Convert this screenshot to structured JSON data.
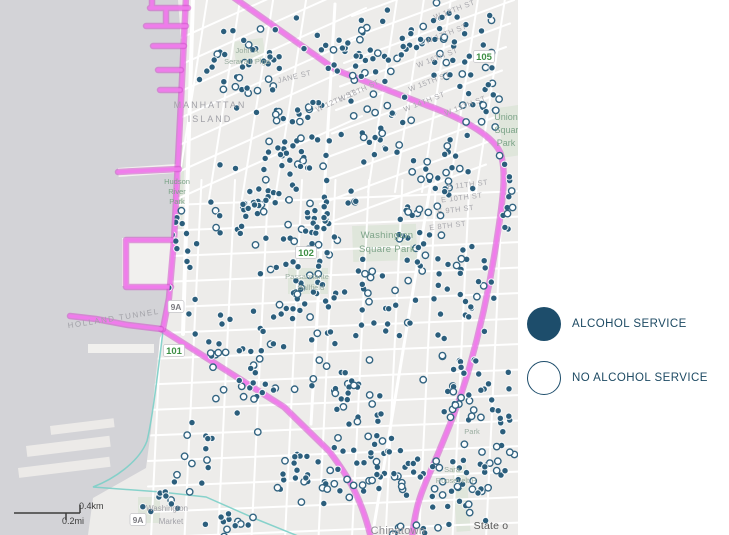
{
  "legend": {
    "items": [
      {
        "label": "ALCOHOL SERVICE",
        "type": "filled"
      },
      {
        "label": "NO ALCOHOL SERVICE",
        "type": "outlined"
      }
    ]
  },
  "colors": {
    "water": "#d3d3d7",
    "land": "#edecea",
    "street": "#ffffff",
    "park": "#dfe6db",
    "pier": "#f1f0ee",
    "pier2": "#eceae8",
    "magenta_outer": "#cf4ecb",
    "magenta_inner": "#f07bec",
    "teal": "#7bcfc8",
    "dot_fill": "#2b5e7c",
    "dot_rim": "rgba(255,255,255,0.9)",
    "dot_open_fill": "#fbfdfe",
    "dot_open_stroke": "#336481",
    "gray1": "#a2a2a8",
    "gray2": "#8e8e93",
    "gray3": "#a9a9ae",
    "green1": "#7da489",
    "green2": "#9aada0",
    "shield_green": "#3e8f45",
    "shield_gray": "#7c7c82",
    "attribution": "#565656",
    "scale": "#3c3c3c",
    "legend_fill": "#1d4d6b",
    "legend_ring": "#1d4d6b"
  },
  "map": {
    "width": 518,
    "height": 535,
    "land_path": "M178,0 L518,0 L518,535 L88,535 L93,498 L146,468 L151,430 L154,392 L160,338 L164,330 L169,296 L173,246 L177,178 L181,92 L181,40 Z",
    "piers": [
      {
        "x": 122,
        "y": 238,
        "w": 50,
        "h": 48,
        "rot": 0,
        "c": "pier"
      },
      {
        "x": 88,
        "y": 344,
        "w": 66,
        "h": 9,
        "rot": 0,
        "c": "pier"
      },
      {
        "x": 118,
        "y": 168,
        "w": 60,
        "h": 9,
        "rot": -4,
        "c": "pier"
      },
      {
        "x": 26,
        "y": 446,
        "w": 84,
        "h": 11,
        "rot": -7,
        "c": "pier2"
      },
      {
        "x": 50,
        "y": 426,
        "w": 64,
        "h": 9,
        "rot": -7,
        "c": "pier2"
      },
      {
        "x": 18,
        "y": 468,
        "w": 92,
        "h": 10,
        "rot": -7,
        "c": "pier2"
      }
    ],
    "parks": [
      {
        "x": 352,
        "y": 226,
        "w": 64,
        "h": 36,
        "rot": -2
      },
      {
        "x": 497,
        "y": 108,
        "w": 23,
        "h": 50,
        "rot": -8
      },
      {
        "x": 176,
        "y": 145,
        "w": 9,
        "h": 85,
        "rot": 2
      },
      {
        "x": 138,
        "y": 497,
        "w": 22,
        "h": 26,
        "rot": 0
      },
      {
        "x": 452,
        "y": 466,
        "w": 14,
        "h": 66,
        "rot": -4
      },
      {
        "x": 233,
        "y": 42,
        "w": 30,
        "h": 22,
        "rot": -8
      },
      {
        "x": 288,
        "y": 268,
        "w": 40,
        "h": 26,
        "rot": 0
      }
    ],
    "street_regions": [
      {
        "count": 10,
        "start": [
          352,
          16
        ],
        "step": [
          -4,
          23.5
        ],
        "vec": [
          170,
          -63
        ],
        "width": 2
      },
      {
        "count": 5,
        "start": [
          398,
          -8
        ],
        "step": [
          27,
          0
        ],
        "vec": [
          -30,
          200
        ],
        "width": 2
      },
      {
        "count": 7,
        "start": [
          163,
          46
        ],
        "step": [
          -1,
          27
        ],
        "vec": [
          205,
          -92
        ],
        "width": 2
      },
      {
        "count": 4,
        "start": [
          208,
          -6
        ],
        "step": [
          33,
          0
        ],
        "vec": [
          -32,
          205
        ],
        "width": 2
      },
      {
        "count": 11,
        "start": [
          168,
          180
        ],
        "step": [
          33.5,
          0
        ],
        "vec": [
          -17,
          358
        ],
        "width": 2
      },
      {
        "count": 14,
        "start": [
          148,
          206
        ],
        "step": [
          0,
          25.5
        ],
        "vec": [
          374,
          -15
        ],
        "width": 2
      },
      {
        "count": 1,
        "start": [
          432,
          176
        ],
        "step": [
          0,
          0
        ],
        "vec": [
          -60,
          362
        ],
        "width": 3
      },
      {
        "count": 1,
        "start": [
          193,
          -4
        ],
        "step": [
          0,
          0
        ],
        "vec": [
          -10,
          338
        ],
        "width": 4
      },
      {
        "count": 1,
        "start": [
          335,
          4
        ],
        "step": [
          0,
          0
        ],
        "vec": [
          -24,
          420
        ],
        "width": 3
      }
    ],
    "teal_path": "M163,331 C156,388 152,420 147,441 C139,462 114,479 93,487 L161,492 L206,497 L256,519 L298,536",
    "boundary_paths": [
      "M233,-3 L336,70 L426,105 C460,117 492,135 500,152 C507,170 503,200 497,238 C490,286 480,330 469,369 C458,407 447,432 432,468 C421,492 415,508 412,538",
      "M161,329 L224,369 L284,407 L329,451 C349,477 362,500 371,538",
      "M186,-3 L182,80 L178,160 L174,240 L169,298 L163,329",
      "M150,8 L188,8 M152,-2 L152,8 M146,26 L186,26 M166,8 L166,26 M153,46 L184,46 M158,70 L181,70 M160,90 L180,90 M118,172 L179,169 M172,240 L126,240 L126,287 L171,287 M161,329 L128,325 L96,319 L70,316"
    ],
    "dot_style": {
      "r": 3.2
    },
    "dot_clusters": [
      {
        "c": [
          250,
          60
        ],
        "r": [
          60,
          55
        ],
        "n": 40,
        "f": 0.8
      },
      {
        "c": [
          350,
          45
        ],
        "r": [
          50,
          45
        ],
        "n": 35,
        "f": 0.75
      },
      {
        "c": [
          445,
          40
        ],
        "r": [
          60,
          45
        ],
        "n": 45,
        "f": 0.7
      },
      {
        "c": [
          480,
          100
        ],
        "r": [
          35,
          50
        ],
        "n": 25,
        "f": 0.7
      },
      {
        "c": [
          300,
          140
        ],
        "r": [
          55,
          55
        ],
        "n": 45,
        "f": 0.8
      },
      {
        "c": [
          380,
          130
        ],
        "r": [
          40,
          40
        ],
        "n": 25,
        "f": 0.75
      },
      {
        "c": [
          250,
          200
        ],
        "r": [
          45,
          60
        ],
        "n": 40,
        "f": 0.8
      },
      {
        "c": [
          320,
          220
        ],
        "r": [
          45,
          50
        ],
        "n": 40,
        "f": 0.7
      },
      {
        "c": [
          440,
          180
        ],
        "r": [
          45,
          55
        ],
        "n": 30,
        "f": 0.6
      },
      {
        "c": [
          300,
          300
        ],
        "r": [
          55,
          50
        ],
        "n": 45,
        "f": 0.75
      },
      {
        "c": [
          380,
          300
        ],
        "r": [
          40,
          50
        ],
        "n": 25,
        "f": 0.7
      },
      {
        "c": [
          460,
          290
        ],
        "r": [
          40,
          60
        ],
        "n": 30,
        "f": 0.65
      },
      {
        "c": [
          250,
          380
        ],
        "r": [
          50,
          55
        ],
        "n": 30,
        "f": 0.7
      },
      {
        "c": [
          350,
          390
        ],
        "r": [
          45,
          50
        ],
        "n": 30,
        "f": 0.6
      },
      {
        "c": [
          460,
          400
        ],
        "r": [
          45,
          55
        ],
        "n": 35,
        "f": 0.65
      },
      {
        "c": [
          380,
          470
        ],
        "r": [
          55,
          45
        ],
        "n": 45,
        "f": 0.6
      },
      {
        "c": [
          460,
          480
        ],
        "r": [
          50,
          45
        ],
        "n": 40,
        "f": 0.7
      },
      {
        "c": [
          300,
          480
        ],
        "r": [
          45,
          40
        ],
        "n": 25,
        "f": 0.65
      },
      {
        "c": [
          200,
          450
        ],
        "r": [
          30,
          60
        ],
        "n": 15,
        "f": 0.7
      },
      {
        "c": [
          185,
          250
        ],
        "r": [
          20,
          70
        ],
        "n": 15,
        "f": 0.8
      },
      {
        "c": [
          210,
          330
        ],
        "r": [
          25,
          40
        ],
        "n": 12,
        "f": 0.7
      },
      {
        "c": [
          420,
          240
        ],
        "r": [
          30,
          40
        ],
        "n": 18,
        "f": 0.6
      },
      {
        "c": [
          505,
          200
        ],
        "r": [
          14,
          80
        ],
        "n": 12,
        "f": 0.6
      },
      {
        "c": [
          505,
          420
        ],
        "r": [
          14,
          70
        ],
        "n": 12,
        "f": 0.65
      },
      {
        "c": [
          230,
          520
        ],
        "r": [
          40,
          18
        ],
        "n": 12,
        "f": 0.6
      },
      {
        "c": [
          160,
          500
        ],
        "r": [
          25,
          25
        ],
        "n": 8,
        "f": 0.75
      },
      {
        "c": [
          420,
          528
        ],
        "r": [
          40,
          10
        ],
        "n": 10,
        "f": 0.6
      }
    ],
    "labels": [
      {
        "t": "MANHATTAN",
        "x": 210,
        "y": 108,
        "rot": 0,
        "s": 9,
        "c": "gray1",
        "ls": 2
      },
      {
        "t": "ISLAND",
        "x": 210,
        "y": 122,
        "rot": 0,
        "s": 9,
        "c": "gray1",
        "ls": 2
      },
      {
        "t": "HOLLAND TUNNEL",
        "x": 114,
        "y": 321,
        "rot": -9,
        "s": 8,
        "c": "gray1",
        "ls": 1.5
      },
      {
        "t": "Hudson",
        "x": 177,
        "y": 184,
        "rot": 0,
        "s": 7.5,
        "c": "green1",
        "ls": 0
      },
      {
        "t": "River",
        "x": 177,
        "y": 194,
        "rot": 0,
        "s": 7.5,
        "c": "green1",
        "ls": 0
      },
      {
        "t": "Park",
        "x": 177,
        "y": 204,
        "rot": 0,
        "s": 7.5,
        "c": "green1",
        "ls": 0
      },
      {
        "t": "Washington",
        "x": 387,
        "y": 238,
        "rot": 0,
        "s": 9.5,
        "c": "green1",
        "ls": 0.3
      },
      {
        "t": "Square Park",
        "x": 387,
        "y": 252,
        "rot": 0,
        "s": 9.5,
        "c": "green1",
        "ls": 0.3
      },
      {
        "t": "Union",
        "x": 506,
        "y": 120,
        "rot": 0,
        "s": 9,
        "c": "green1",
        "ls": 0
      },
      {
        "t": "Square",
        "x": 509,
        "y": 133,
        "rot": 0,
        "s": 9,
        "c": "green1",
        "ls": 0
      },
      {
        "t": "Park",
        "x": 506,
        "y": 146,
        "rot": 0,
        "s": 9,
        "c": "green1",
        "ls": 0
      },
      {
        "t": "Chinatown",
        "x": 398,
        "y": 534,
        "rot": 0,
        "s": 11,
        "c": "gray2",
        "ls": 0.3
      },
      {
        "t": "Washington",
        "x": 167,
        "y": 511,
        "rot": 0,
        "s": 8,
        "c": "gray1",
        "ls": 0
      },
      {
        "t": "Market",
        "x": 171,
        "y": 524,
        "rot": 0,
        "s": 8,
        "c": "gray1",
        "ls": 0
      },
      {
        "t": "John A",
        "x": 247,
        "y": 53,
        "rot": 0,
        "s": 7.5,
        "c": "green2",
        "ls": 0
      },
      {
        "t": "Seravalli Plgd",
        "x": 247,
        "y": 64,
        "rot": 0,
        "s": 7.5,
        "c": "green2",
        "ls": 0
      },
      {
        "t": "Passannante",
        "x": 307,
        "y": 279,
        "rot": 0,
        "s": 7.5,
        "c": "green2",
        "ls": 0
      },
      {
        "t": "Ballfield",
        "x": 311,
        "y": 290,
        "rot": 0,
        "s": 7.5,
        "c": "green2",
        "ls": 0
      },
      {
        "t": "Sara",
        "x": 452,
        "y": 472,
        "rot": 0,
        "s": 7.5,
        "c": "green2",
        "ls": 0
      },
      {
        "t": "Roosevelt P",
        "x": 456,
        "y": 483,
        "rot": 0,
        "s": 7.5,
        "c": "green2",
        "ls": 0
      },
      {
        "t": "Park",
        "x": 472,
        "y": 434,
        "rot": 0,
        "s": 7.5,
        "c": "green2",
        "ls": 0
      },
      {
        "t": "JANE ST",
        "x": 295,
        "y": 79,
        "rot": -14,
        "s": 7.5,
        "c": "gray3",
        "ls": 0.5
      },
      {
        "t": "W 13TH ST",
        "x": 360,
        "y": 93,
        "rot": -25,
        "s": 7.5,
        "c": "gray3",
        "ls": 0.5
      },
      {
        "t": "W 12TH ST",
        "x": 337,
        "y": 103,
        "rot": -25,
        "s": 7.5,
        "c": "gray3",
        "ls": 0.5
      },
      {
        "t": "W 18TH ST",
        "x": 455,
        "y": 12,
        "rot": -21,
        "s": 7.5,
        "c": "gray3",
        "ls": 0.5
      },
      {
        "t": "W 17TH ST",
        "x": 447,
        "y": 36,
        "rot": -21,
        "s": 7.5,
        "c": "gray3",
        "ls": 0.5
      },
      {
        "t": "W 16TH ST",
        "x": 438,
        "y": 60,
        "rot": -21,
        "s": 7.5,
        "c": "gray3",
        "ls": 0.5
      },
      {
        "t": "W 15TH ST",
        "x": 430,
        "y": 84,
        "rot": -21,
        "s": 7.5,
        "c": "gray3",
        "ls": 0.5
      },
      {
        "t": "W 14TH ST",
        "x": 425,
        "y": 104,
        "rot": -21,
        "s": 7.5,
        "c": "gray3",
        "ls": 0.5
      },
      {
        "t": "W 13TH ST",
        "x": 466,
        "y": 108,
        "rot": -21,
        "s": 7.5,
        "c": "gray3",
        "ls": 0.5
      },
      {
        "t": "E 11TH ST",
        "x": 468,
        "y": 187,
        "rot": -7,
        "s": 7.5,
        "c": "gray3",
        "ls": 0.5
      },
      {
        "t": "E 10TH ST",
        "x": 462,
        "y": 200,
        "rot": -7,
        "s": 7.5,
        "c": "gray3",
        "ls": 0.5
      },
      {
        "t": "E 9TH ST",
        "x": 456,
        "y": 212,
        "rot": -7,
        "s": 7.5,
        "c": "gray3",
        "ls": 0.5
      },
      {
        "t": "E 8TH ST",
        "x": 448,
        "y": 228,
        "rot": -7,
        "s": 7.5,
        "c": "gray3",
        "ls": 0.5
      },
      {
        "t": "State o",
        "x": 491,
        "y": 529,
        "rot": 0,
        "s": 10.5,
        "c": "attribution",
        "ls": 0.2
      }
    ],
    "shields": [
      {
        "t": "105",
        "x": 484,
        "y": 57,
        "style": "green"
      },
      {
        "t": "102",
        "x": 306,
        "y": 253,
        "style": "green"
      },
      {
        "t": "101",
        "x": 174,
        "y": 351,
        "style": "green"
      },
      {
        "t": "9A",
        "x": 176,
        "y": 307,
        "style": "white"
      },
      {
        "t": "9A",
        "x": 138,
        "y": 520,
        "style": "white"
      }
    ],
    "scale_bar": {
      "km_label": "0.4km",
      "mi_label": "0.2mi",
      "line": [
        14,
        513,
        80,
        513
      ],
      "km_tick": [
        80,
        505,
        80,
        513
      ],
      "mi_tick": [
        66,
        513,
        66,
        520
      ],
      "km_pos": [
        79,
        509
      ],
      "mi_pos": [
        62,
        524
      ]
    }
  }
}
